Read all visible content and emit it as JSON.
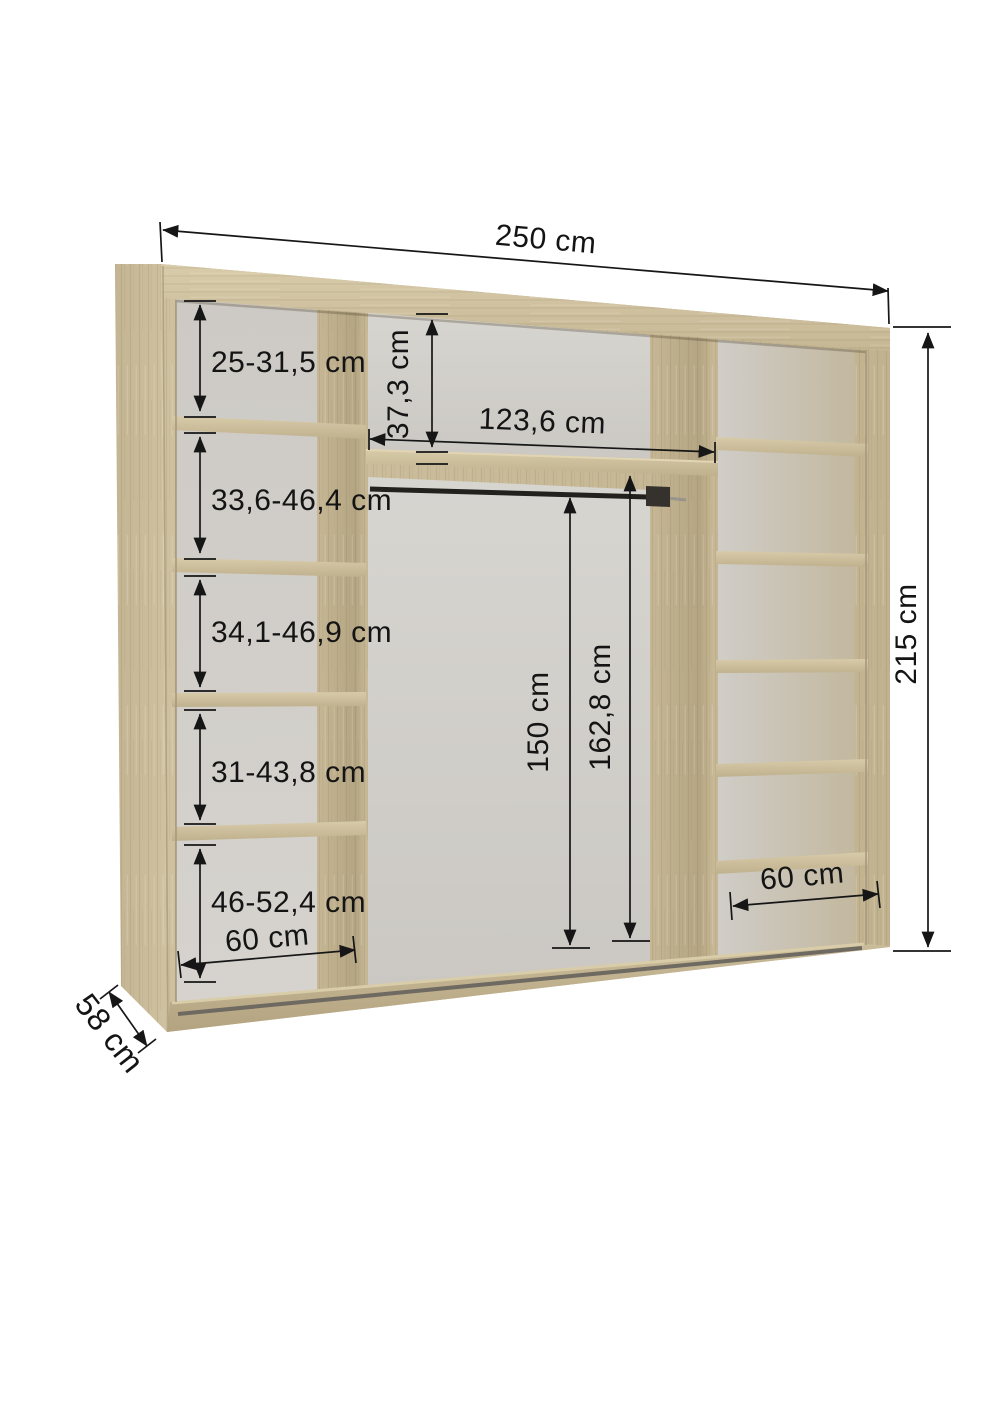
{
  "diagram": {
    "type": "wardrobe-interior-dimension-drawing",
    "unit": "cm"
  },
  "dims": {
    "total_width": "250 cm",
    "total_height": "215 cm",
    "depth": "58 cm",
    "left_compartments": [
      "25-31,5 cm",
      "33,6-46,4 cm",
      "34,1-46,9 cm",
      "31-43,8 cm",
      "46-52,4 cm"
    ],
    "left_bottom_width": "60 cm",
    "mid_top_gap": "37,3 cm",
    "mid_inner_width": "123,6 cm",
    "rail_height": "150 cm",
    "mid_clearance_height": "162,8 cm",
    "right_bottom_width": "60 cm"
  },
  "colors": {
    "wood_light": "#d8cba9",
    "wood_mid": "#cbbd9b",
    "wood_dark": "#ab9c7a",
    "interior_gray": "#d2cfca",
    "dimension_line": "#161616",
    "background": "#ffffff"
  }
}
